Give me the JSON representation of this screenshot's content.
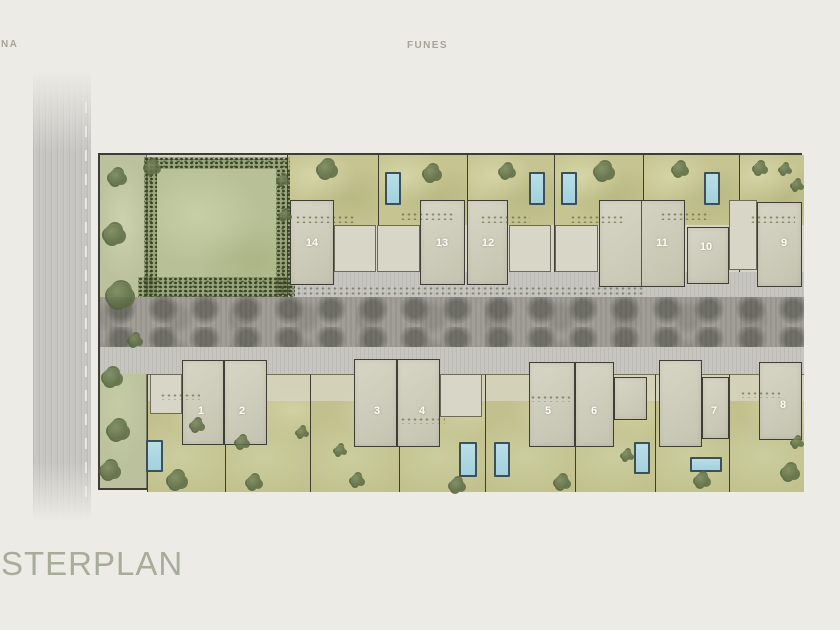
{
  "page": {
    "street_label_left": "NA",
    "street_label_top": "FUNES",
    "title": "STERPLAN"
  },
  "palette": {
    "bg": "#ecebe5",
    "ink": "#3e3e34",
    "apron": "#d6d4c6",
    "walk": "#c7c5bf",
    "road": "#a09e97",
    "lroad": "#c7c5c1",
    "yard": "#c6c491",
    "yard2": "#c2c18d",
    "park": "#b7c096",
    "strip": "#bac19c",
    "house": "#cdccba",
    "patio": "#d8d6c6",
    "pool": "#a2d1dd",
    "pool_border": "#3d5057",
    "label": "#fdfdf8",
    "title_color": "#a8ad9b",
    "street_color": "#a7a39a"
  },
  "plan": {
    "top_lots": [
      {
        "number": "14",
        "x": 187,
        "w": 91,
        "houses": [
          [
            190,
            45,
            44,
            85
          ]
        ],
        "patios": [
          [
            234,
            70,
            42,
            47
          ]
        ],
        "pools": [],
        "label": [
          212,
          88
        ]
      },
      {
        "number": "13",
        "x": 278,
        "w": 89,
        "houses": [
          [
            320,
            45,
            45,
            85
          ]
        ],
        "patios": [
          [
            277,
            70,
            43,
            47
          ]
        ],
        "pools": [
          [
            285,
            17,
            16,
            33
          ]
        ],
        "label": [
          342,
          88
        ]
      },
      {
        "number": "12",
        "x": 367,
        "w": 87,
        "houses": [
          [
            367,
            45,
            41,
            85
          ]
        ],
        "patios": [
          [
            409,
            70,
            42,
            47
          ]
        ],
        "pools": [
          [
            429,
            17,
            16,
            33
          ]
        ],
        "label": [
          388,
          88
        ]
      },
      {
        "number": "11",
        "x": 454,
        "w": 89,
        "houses": [
          [
            499,
            45,
            86,
            87
          ]
        ],
        "dividers": [
          [
            541,
            45,
            1,
            87
          ]
        ],
        "patios": [
          [
            455,
            70,
            43,
            47
          ]
        ],
        "pools": [
          [
            461,
            17,
            16,
            33
          ]
        ],
        "label": [
          562,
          88
        ]
      },
      {
        "number": "10",
        "x": 543,
        "w": 96,
        "houses": [
          [
            587,
            72,
            42,
            57
          ]
        ],
        "patios": [],
        "pools": [
          [
            604,
            17,
            16,
            33
          ]
        ],
        "label": [
          606,
          92
        ]
      },
      {
        "number": "9",
        "x": 639,
        "w": 65,
        "houses": [
          [
            657,
            47,
            45,
            85
          ]
        ],
        "patios": [
          [
            629,
            45,
            28,
            70
          ]
        ],
        "pools": [],
        "label": [
          684,
          88
        ]
      }
    ],
    "bottom_lots": [
      {
        "number": "1",
        "x": 47,
        "w": 78,
        "houses": [
          [
            82,
            205,
            42,
            85
          ]
        ],
        "patios": [
          [
            50,
            219,
            32,
            40
          ]
        ],
        "pools": [
          [
            46,
            285,
            17,
            32
          ]
        ],
        "label": [
          101,
          256
        ]
      },
      {
        "number": "2",
        "x": 125,
        "w": 85,
        "houses": [
          [
            124,
            205,
            43,
            85
          ]
        ],
        "patios": [],
        "pools": [],
        "label": [
          142,
          256
        ]
      },
      {
        "number": "3",
        "x": 210,
        "w": 89,
        "houses": [
          [
            254,
            204,
            43,
            88
          ]
        ],
        "patios": [],
        "pools": [],
        "label": [
          277,
          256
        ]
      },
      {
        "number": "4",
        "x": 299,
        "w": 86,
        "houses": [
          [
            297,
            204,
            43,
            88
          ]
        ],
        "patios": [
          [
            340,
            219,
            42,
            43
          ]
        ],
        "pools": [
          [
            359,
            287,
            18,
            35
          ]
        ],
        "label": [
          322,
          256
        ]
      },
      {
        "number": "5",
        "x": 385,
        "w": 90,
        "houses": [
          [
            429,
            207,
            46,
            85
          ]
        ],
        "patios": [],
        "pools": [
          [
            394,
            287,
            16,
            35
          ]
        ],
        "label": [
          448,
          256
        ]
      },
      {
        "number": "6",
        "x": 475,
        "w": 80,
        "houses": [
          [
            475,
            207,
            39,
            85
          ],
          [
            514,
            222,
            33,
            43
          ]
        ],
        "patios": [],
        "pools": [
          [
            534,
            287,
            16,
            32
          ]
        ],
        "label": [
          494,
          256
        ]
      },
      {
        "number": "7",
        "x": 555,
        "w": 74,
        "houses": [
          [
            559,
            205,
            43,
            87
          ],
          [
            602,
            222,
            27,
            62
          ]
        ],
        "patios": [],
        "pools": [
          [
            590,
            302,
            32,
            15
          ]
        ],
        "label": [
          614,
          256
        ]
      },
      {
        "number": "8",
        "x": 629,
        "w": 75,
        "houses": [
          [
            659,
            207,
            43,
            78
          ]
        ],
        "patios": [],
        "pools": [],
        "label": [
          683,
          250
        ]
      }
    ],
    "trees": [
      [
        17,
        22,
        8
      ],
      [
        14,
        79,
        10
      ],
      [
        20,
        140,
        13
      ],
      [
        12,
        222,
        9
      ],
      [
        18,
        275,
        10
      ],
      [
        10,
        315,
        9
      ],
      [
        35,
        185,
        6
      ],
      [
        52,
        12,
        7
      ],
      [
        183,
        25,
        5
      ],
      [
        185,
        60,
        5
      ],
      [
        227,
        14,
        9
      ],
      [
        332,
        18,
        8
      ],
      [
        407,
        16,
        7
      ],
      [
        504,
        16,
        9
      ],
      [
        580,
        14,
        7
      ],
      [
        660,
        13,
        6
      ],
      [
        697,
        30,
        5
      ],
      [
        685,
        14,
        5
      ],
      [
        77,
        325,
        9
      ],
      [
        154,
        327,
        7
      ],
      [
        257,
        325,
        6
      ],
      [
        357,
        330,
        7
      ],
      [
        462,
        327,
        7
      ],
      [
        527,
        300,
        5
      ],
      [
        602,
        325,
        7
      ],
      [
        690,
        317,
        8
      ],
      [
        697,
        287,
        5
      ],
      [
        142,
        287,
        6
      ],
      [
        202,
        277,
        5
      ],
      [
        240,
        295,
        5
      ],
      [
        97,
        270,
        6
      ]
    ],
    "shrubs": [
      [
        195,
        60,
        60,
        8
      ],
      [
        300,
        57,
        55,
        8
      ],
      [
        380,
        60,
        50,
        8
      ],
      [
        470,
        60,
        55,
        8
      ],
      [
        560,
        57,
        50,
        8
      ],
      [
        650,
        60,
        45,
        8
      ],
      [
        190,
        131,
        355,
        9
      ],
      [
        60,
        238,
        40,
        7
      ],
      [
        300,
        262,
        45,
        7
      ],
      [
        430,
        240,
        40,
        7
      ],
      [
        640,
        236,
        40,
        7
      ]
    ]
  }
}
